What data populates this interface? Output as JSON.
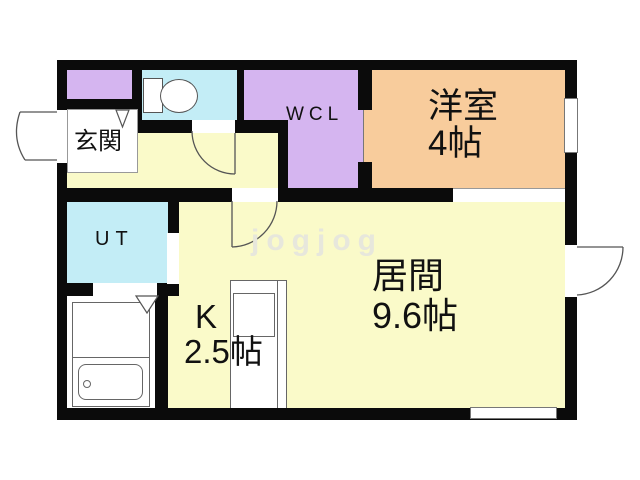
{
  "floorplan": {
    "type": "apartment-floor-plan",
    "rooms": {
      "entrance": {
        "label": "玄関"
      },
      "walk_in_closet": {
        "label": "WCL"
      },
      "western_room": {
        "label": "洋室",
        "size": "4帖"
      },
      "utility": {
        "label": "UT"
      },
      "kitchen": {
        "label": "K",
        "size": "2.5帖"
      },
      "living_room": {
        "label": "居間",
        "size": "9.6帖"
      }
    },
    "fixtures": [
      "toilet",
      "bathtub",
      "kitchen-counter-with-sink"
    ],
    "watermark": "jogjog",
    "colors": {
      "floor_yellow": "#FAFAC9",
      "western_orange": "#F8CC9C",
      "closet_purple": "#D5B5F0",
      "wet_area_cyan": "#C3EDF6",
      "bath_white": "#FFFFFF",
      "wall_black": "#0B0B0B",
      "line_gray": "#666666"
    }
  }
}
